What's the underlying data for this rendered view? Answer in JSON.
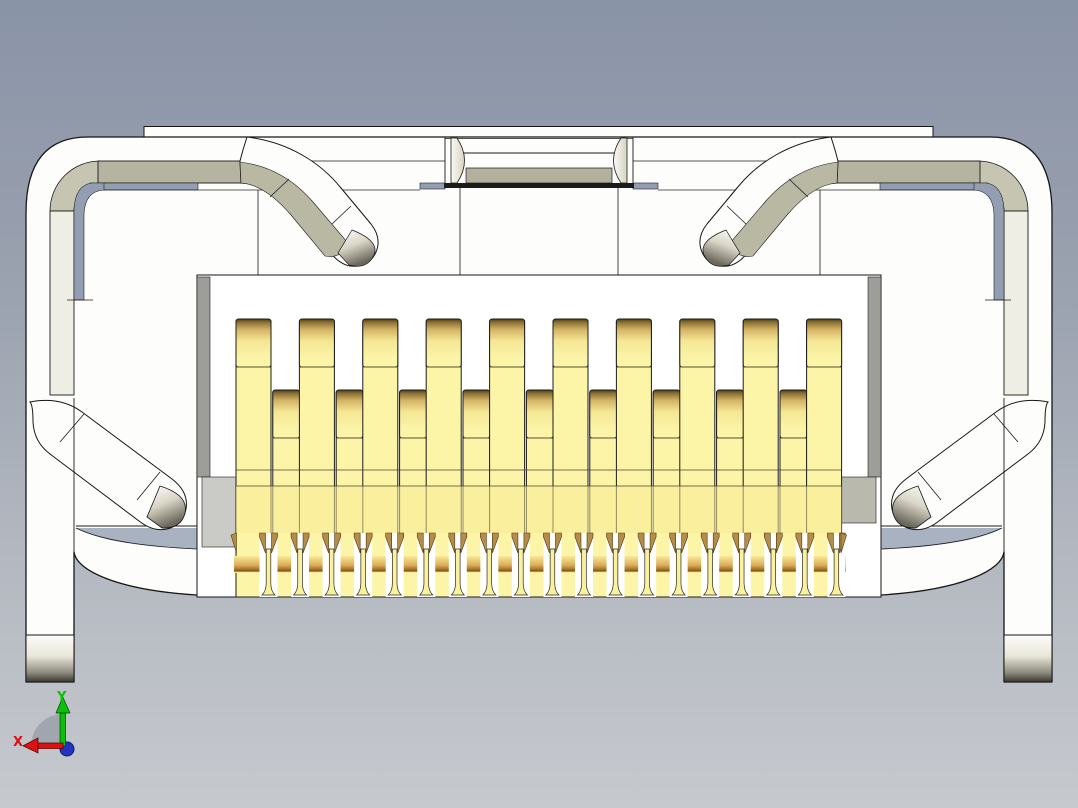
{
  "viewport": {
    "kind": "cad-3d-viewport",
    "background_top": "#8a94a7",
    "background_bottom": "#c6c9ce"
  },
  "axis_triad": {
    "x_label": "X",
    "y_label": "Y",
    "x_color": "#e01010",
    "y_color": "#00c800",
    "z_color": "#2334c0",
    "sector_color": "#969ca6"
  },
  "model": {
    "description": "SMT micro-HDMI style connector shown from the front with gold contacts",
    "colors": {
      "shell_white": "#fdfdfb",
      "outline": "#161616",
      "khaki_band": "#b5b4a0",
      "cream_band": "#efeee4",
      "gap_blue": "#939eb2",
      "wedge_blue": "#a9b2c1",
      "pin_gold_body": "#fcf5a8",
      "pin_gold_dark": "#5a4a1e",
      "pin_band_amber": "#9c6c24",
      "wedge_tan": "#b68c48",
      "gray_column": "#9d9d99"
    },
    "pins": {
      "front": {
        "count": 10,
        "x0": 236,
        "pitch": 63.4,
        "width": 35,
        "top": 319,
        "cap_h": 48,
        "seam_y": 367
      },
      "back": {
        "count": 9,
        "x0": 272.8,
        "pitch": 63.4,
        "width": 26.8,
        "top": 390,
        "cap_h": 48,
        "seam_y": 438
      },
      "total_count": 19,
      "bottom_y": 597,
      "lines_y": [
        470,
        486
      ],
      "deep_section_top": 486,
      "feet": {
        "count": 19,
        "c0": 268.5,
        "pitch": 31.55,
        "gap_w": 18,
        "stem_w": 4.6,
        "stem_top": 549,
        "flare_y": 583,
        "foot_w": 13,
        "foot_y": 595,
        "wedge_top": 533,
        "wedge_bot": 553,
        "band_y": 556,
        "band_h": 17,
        "zone_top": 533,
        "x_min": 234,
        "x_max": 846
      }
    }
  }
}
